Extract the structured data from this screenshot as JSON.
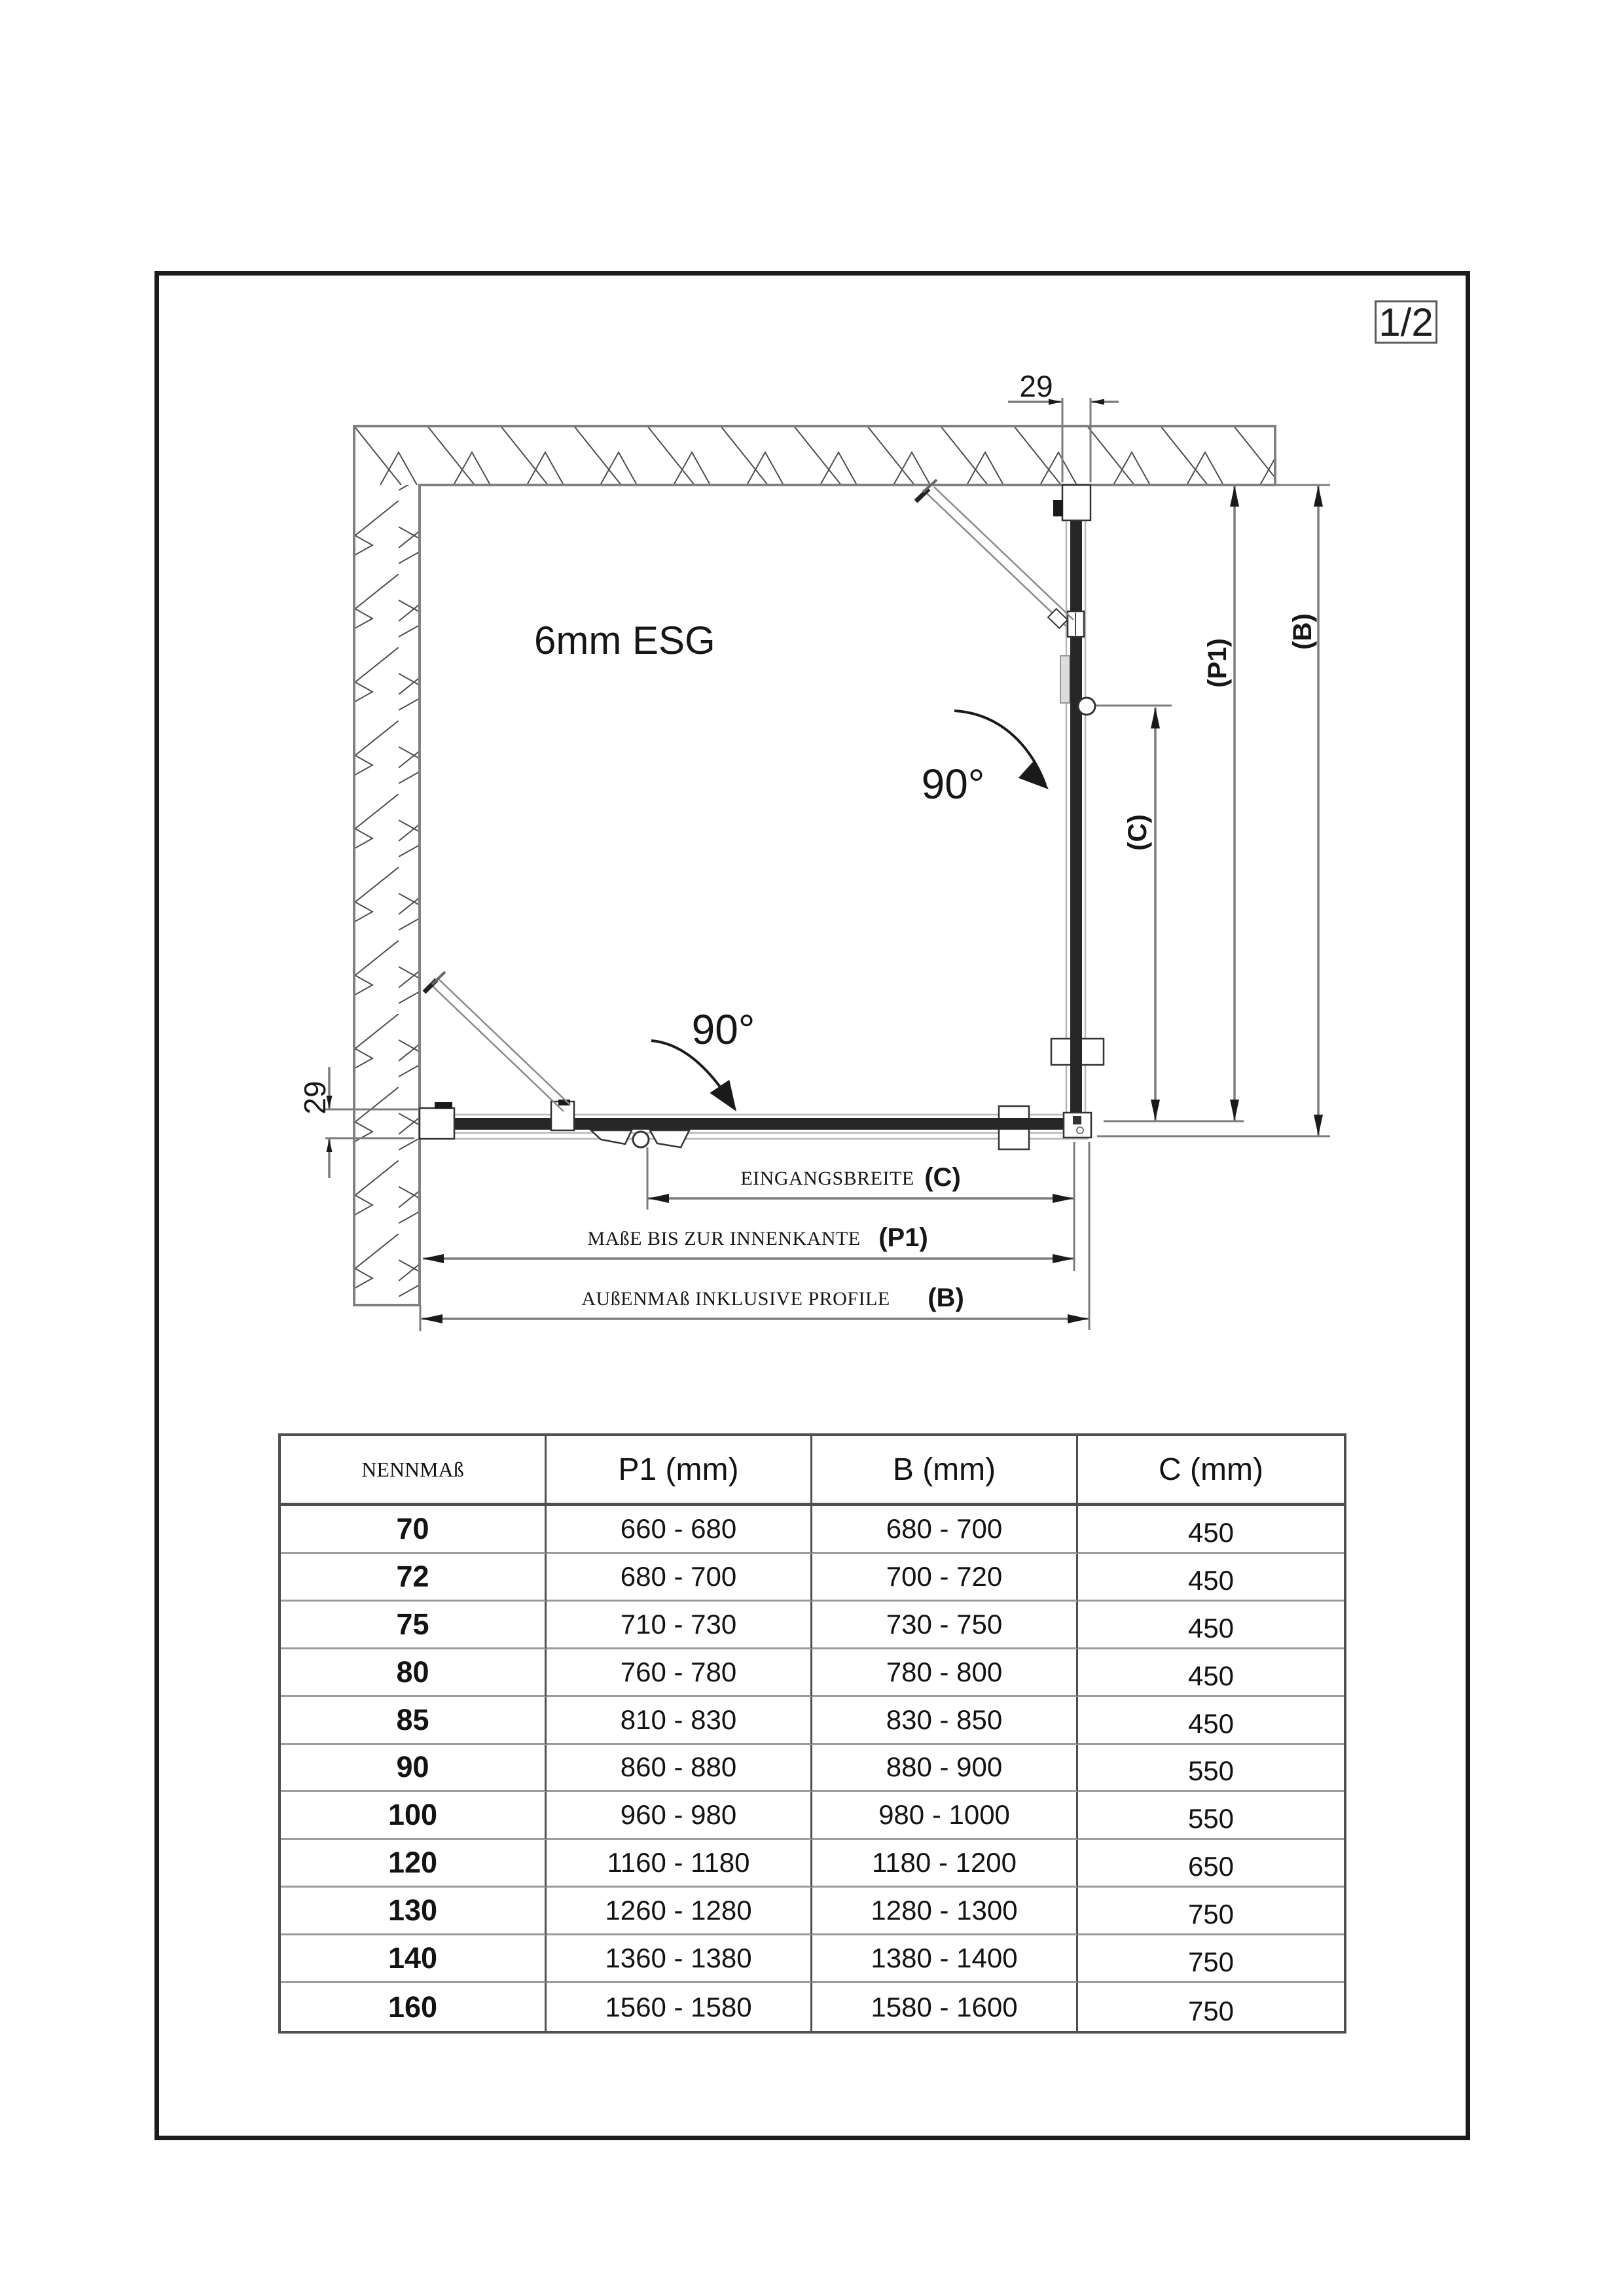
{
  "page": {
    "badge": "1/2"
  },
  "colors": {
    "ink": "#1a1a1a",
    "dimension_line_gray": "#7d7d7d",
    "wall_gray": "#808080",
    "glass_dark": "#262626"
  },
  "drawing": {
    "glass_label": "6mm ESG",
    "angle_right": "90°",
    "angle_bottom": "90°",
    "dim_profile_top": "29",
    "dim_profile_left": "29",
    "dims": {
      "c_label": "EINGANGSBREITE",
      "c_symbol": "(C)",
      "p1_label": "MAßE BIS ZUR INNENKANTE",
      "p1_symbol": "(P1)",
      "b_label": "AUßENMAß INKLUSIVE PROFILE",
      "b_symbol": "(B)"
    }
  },
  "table": {
    "headers": {
      "nennmass": "NENNMAß",
      "p1": "P1 (mm)",
      "b": "B (mm)",
      "c": "C (mm)"
    },
    "rows": [
      {
        "nennmass": "70",
        "p1": "660 - 680",
        "b": "680 - 700",
        "c": "450"
      },
      {
        "nennmass": "72",
        "p1": "680 - 700",
        "b": "700 - 720",
        "c": "450"
      },
      {
        "nennmass": "75",
        "p1": "710 - 730",
        "b": "730 - 750",
        "c": "450"
      },
      {
        "nennmass": "80",
        "p1": "760 - 780",
        "b": "780 - 800",
        "c": "450"
      },
      {
        "nennmass": "85",
        "p1": "810 - 830",
        "b": "830 - 850",
        "c": "450"
      },
      {
        "nennmass": "90",
        "p1": "860 - 880",
        "b": "880 - 900",
        "c": "550"
      },
      {
        "nennmass": "100",
        "p1": "960 - 980",
        "b": "980 - 1000",
        "c": "550"
      },
      {
        "nennmass": "120",
        "p1": "1160 - 1180",
        "b": "1180 - 1200",
        "c": "650"
      },
      {
        "nennmass": "130",
        "p1": "1260 - 1280",
        "b": "1280 - 1300",
        "c": "750"
      },
      {
        "nennmass": "140",
        "p1": "1360 - 1380",
        "b": "1380 - 1400",
        "c": "750"
      },
      {
        "nennmass": "160",
        "p1": "1560 - 1580",
        "b": "1580 - 1600",
        "c": "750"
      }
    ]
  }
}
